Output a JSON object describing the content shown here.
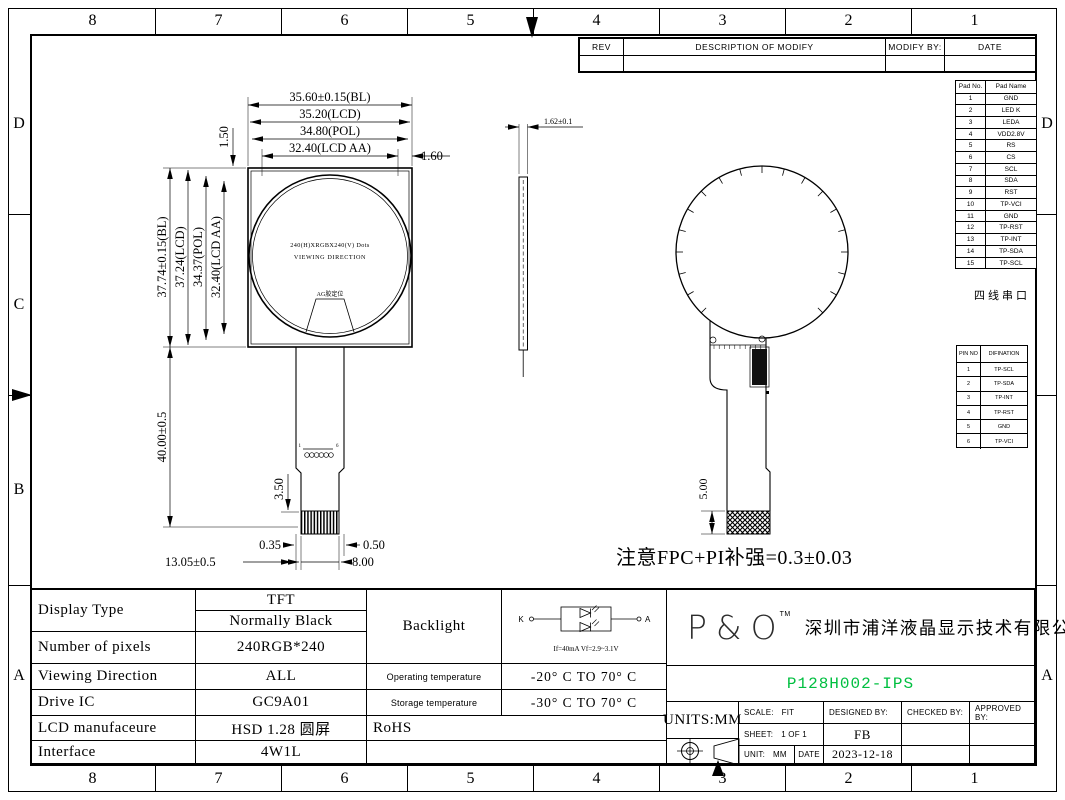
{
  "frame": {
    "top_labels": [
      "8",
      "7",
      "6",
      "5",
      "4",
      "3",
      "2",
      "1"
    ],
    "bottom_labels": [
      "8",
      "7",
      "6",
      "5",
      "4",
      "3",
      "2",
      "1"
    ],
    "left_labels": [
      "D",
      "C",
      "B",
      "A"
    ],
    "right_labels": [
      "D",
      "",
      "",
      "A"
    ]
  },
  "rev_table": {
    "rev": "REV",
    "description": "DESCRIPTION OF MODIFY",
    "modify_by": "MODIFY BY:",
    "date": "DATE"
  },
  "pad_table": {
    "col_no": "Pad No.",
    "col_name": "Pad Name",
    "rows": [
      [
        "1",
        "GND"
      ],
      [
        "2",
        "LED K"
      ],
      [
        "3",
        "LEDA"
      ],
      [
        "4",
        "VDD2.8V"
      ],
      [
        "5",
        "RS"
      ],
      [
        "6",
        "CS"
      ],
      [
        "7",
        "SCL"
      ],
      [
        "8",
        "SDA"
      ],
      [
        "9",
        "RST"
      ],
      [
        "10",
        "TP-VCI"
      ],
      [
        "11",
        "GND"
      ],
      [
        "12",
        "TP-RST"
      ],
      [
        "13",
        "TP-INT"
      ],
      [
        "14",
        "TP-SDA"
      ],
      [
        "15",
        "TP-SCL"
      ]
    ],
    "caption": "四线串口"
  },
  "pin_table": {
    "col_no": "PIN NO",
    "col_def": "DIFINATION",
    "rows": [
      [
        "1",
        "TP-SCL"
      ],
      [
        "2",
        "TP-SDA"
      ],
      [
        "3",
        "TP-INT"
      ],
      [
        "4",
        "TP-RST"
      ],
      [
        "5",
        "GND"
      ],
      [
        "6",
        "TP-VCI"
      ]
    ]
  },
  "front_view": {
    "dim_width_bl": "35.60±0.15(BL)",
    "dim_width_lcd": "35.20(LCD)",
    "dim_width_pol": "34.80(POL)",
    "dim_width_aa": "32.40(LCD AA)",
    "dim_edge_right": "1.60",
    "dim_edge_top": "1.50",
    "dim_height_bl": "37.74±0.15(BL)",
    "dim_height_lcd": "37.24(LCD)",
    "dim_height_pol": "34.37(POL)",
    "dim_height_aa": "32.40(LCD AA)",
    "dim_fpc_length": "40.00±0.5",
    "dim_contact_height": "3.50",
    "dim_offset_left": "0.35",
    "dim_offset_right": "0.50",
    "dim_contact_width": "8.00",
    "dim_contact_pos": "13.05±0.5",
    "center_line1": "240(H)XRGBX240(V) Dots",
    "center_line2": "VIEWING DIRECTION",
    "ag_label": "AG胶定位",
    "pin_first": "1",
    "pin_last": "6"
  },
  "side_view": {
    "dim_thickness": "1.62±0.1"
  },
  "back_view": {
    "dim_stiffener": "5.00"
  },
  "note": "注意FPC+PI补强=0.3±0.03",
  "spec": {
    "display_type_label": "Display Type",
    "display_type_1": "TFT",
    "display_type_2": "Normally Black",
    "pixels_label": "Number of pixels",
    "pixels_value": "240RGB*240",
    "viewing_label": "Viewing Direction",
    "viewing_value": "ALL",
    "drive_ic_label": "Drive IC",
    "drive_ic_value": "GC9A01",
    "manufacture_label": "LCD manufaceure",
    "manufacture_value": "HSD 1.28 圆屏",
    "interface_label": "Interface",
    "interface_value": "4W1L",
    "backlight_label": "Backlight",
    "backlight_k": "K",
    "backlight_a": "A",
    "backlight_spec": "If=40mA  Vf=2.9~3.1V",
    "op_temp_label": "Operating temperature",
    "op_temp_value": "-20° C TO 70° C",
    "st_temp_label": "Storage temperature",
    "st_temp_value": "-30° C TO 70° C",
    "rohs": "RoHS"
  },
  "title_block": {
    "logo": "P&O",
    "logo_tm": "TM",
    "company": "深圳市浦洋液晶显示技术有限公司",
    "part_number": "P128H002-IPS",
    "units": "UNITS:MM",
    "scale_label": "SCALE:",
    "scale_value": "FIT",
    "designed_by": "DESIGNED BY:",
    "checked_by": "CHECKED BY:",
    "approved_by": "APPROVED BY:",
    "sheet_label": "SHEET:",
    "sheet_value": "1 OF 1",
    "designed_value": "FB",
    "unit_label": "UNIT:",
    "unit_value": "MM",
    "date_label": "DATE",
    "date_value": "2023-12-18"
  },
  "colors": {
    "part_number_green": "#00bf40",
    "line": "#000000"
  }
}
